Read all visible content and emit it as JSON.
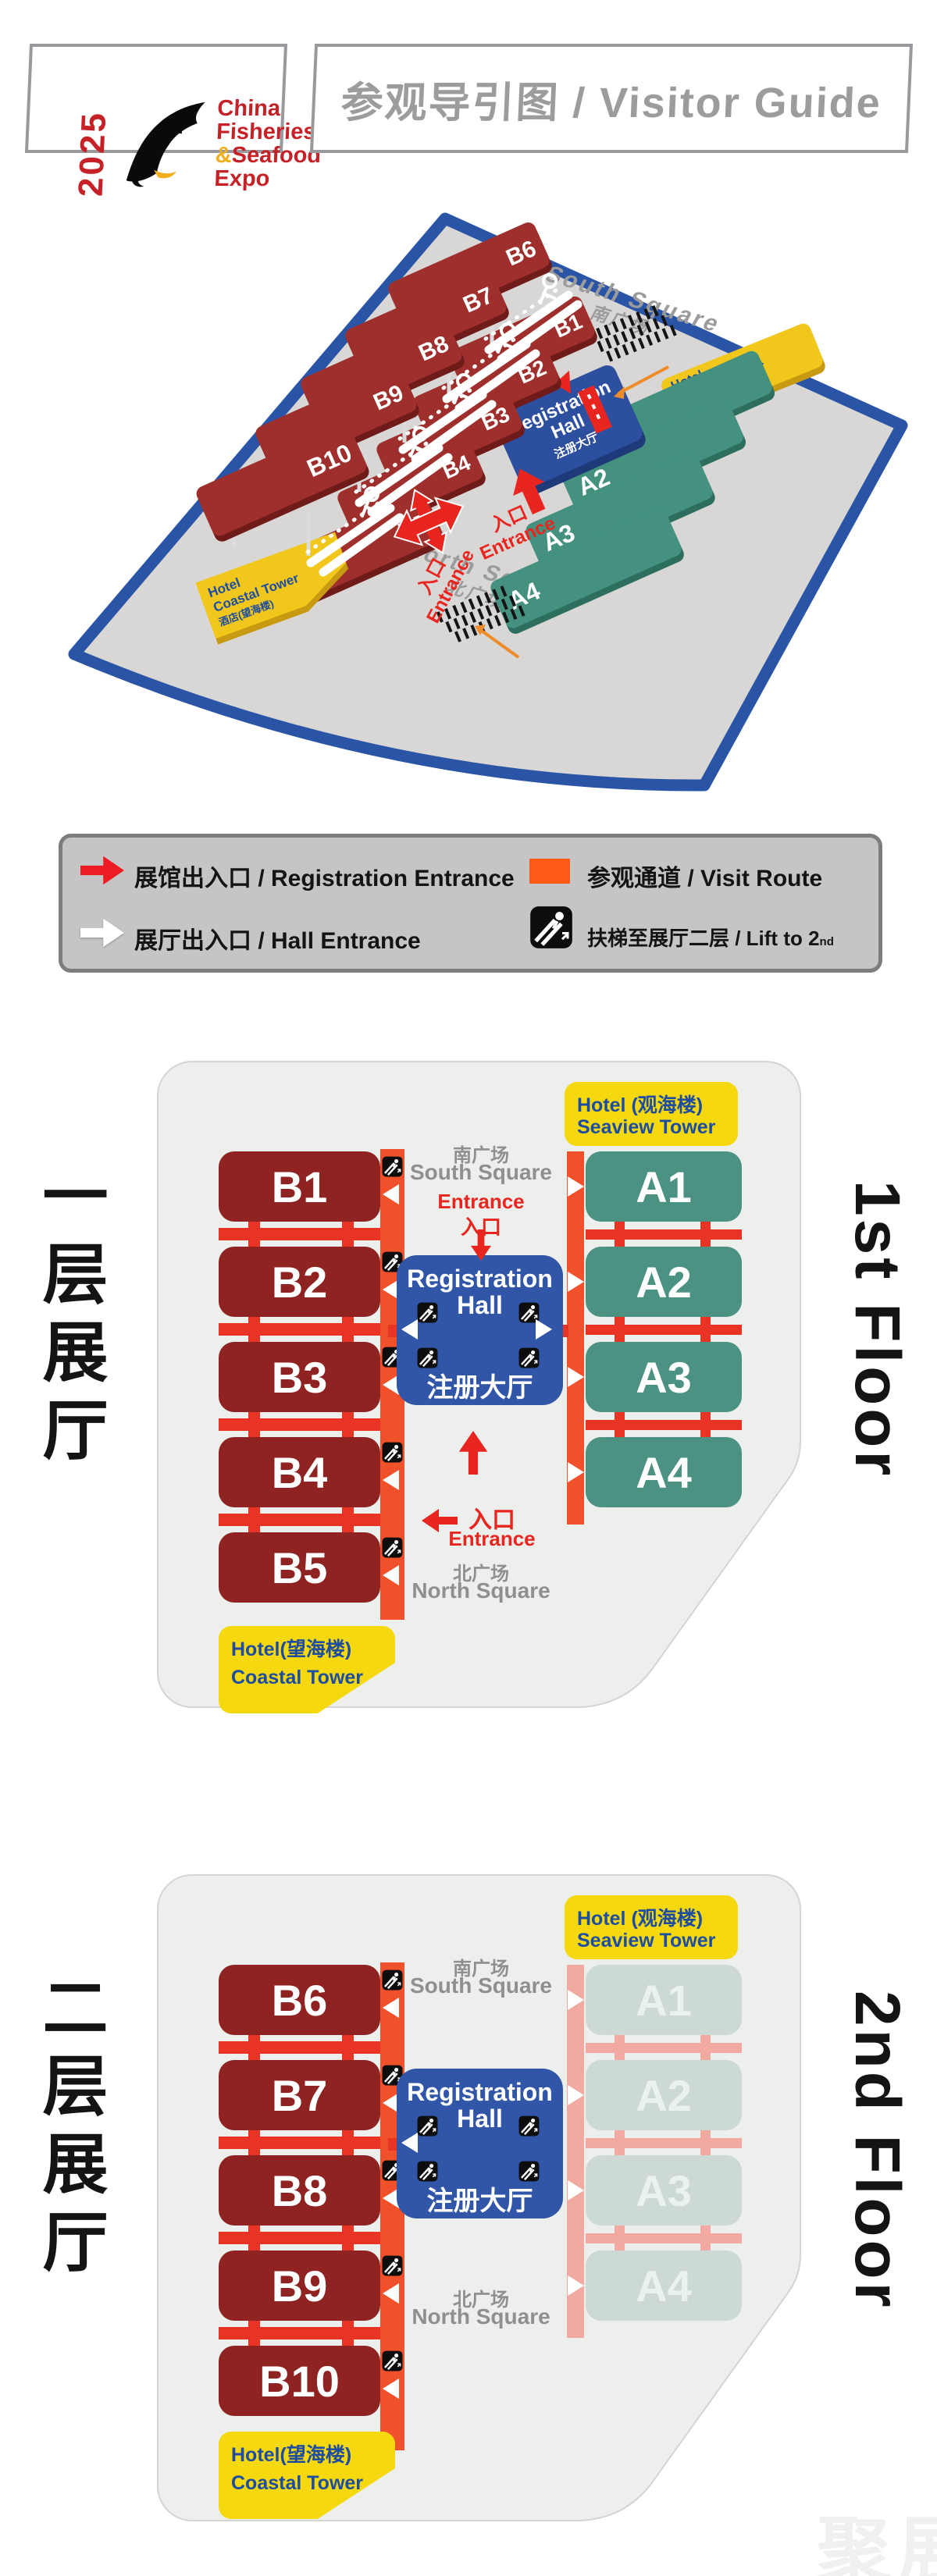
{
  "header": {
    "year": "2025",
    "logo": {
      "l1": "China",
      "l2": "Fisheries",
      "amp": "&",
      "l3": "Seafood",
      "l4": "Expo"
    },
    "title": "参观导引图 / Visitor Guide"
  },
  "legend": {
    "registration_entrance": "展馆出入口 / Registration Entrance",
    "visit_route": "参观通道 / Visit Route",
    "hall_entrance": "展厅出入口 / Hall Entrance",
    "lift_prefix": "扶梯至展厅二层 / Lift to 2",
    "lift_sup": "nd",
    "lift_suffix": " Floor"
  },
  "overview": {
    "south_square_en": "South Square",
    "south_square_zh": "南广场",
    "north_square_en": "North Square",
    "north_square_zh": "北广场",
    "entrance_zh": "入口",
    "entrance_en": "Entrance",
    "hotel_seaview": [
      "Hotel",
      "Seaview Tower",
      "酒店(观海楼)"
    ],
    "hotel_coastal": [
      "Hotel",
      "Coastal Tower",
      "酒店(望海楼)"
    ],
    "registration": [
      "Registration",
      "Hall",
      "注册大厅"
    ],
    "b_upper": [
      "B6",
      "B7",
      "B8",
      "B9",
      "B10"
    ],
    "b_lower": [
      "B1",
      "B2",
      "B3",
      "B4",
      "B5"
    ],
    "a_halls": [
      "A1",
      "A2",
      "A3",
      "A4"
    ]
  },
  "floor1": {
    "side_label": "一层展厅",
    "floor_label": "1st Floor",
    "b_halls": [
      "B1",
      "B2",
      "B3",
      "B4",
      "B5"
    ],
    "a_halls": [
      "A1",
      "A2",
      "A3",
      "A4"
    ],
    "registration_l1": "Registration",
    "registration_l2": "Hall",
    "registration_zh": "注册大厅",
    "south_zh": "南广场",
    "south_en": "South Square",
    "entrance_en": "Entrance",
    "entrance_zh": "入口",
    "north_zh": "北广场",
    "north_en": "North Square",
    "hotel_seaview_l1": "Hotel (观海楼)",
    "hotel_seaview_l2": "Seaview Tower",
    "hotel_coastal_l1": "Hotel(望海楼)",
    "hotel_coastal_l2": "Coastal Tower"
  },
  "floor2": {
    "side_label": "二层展厅",
    "floor_label": "2nd Floor",
    "b_halls": [
      "B6",
      "B7",
      "B8",
      "B9",
      "B10"
    ],
    "a_halls": [
      "A1",
      "A2",
      "A3",
      "A4"
    ],
    "registration_l1": "Registration",
    "registration_l2": "Hall",
    "registration_zh": "注册大厅",
    "south_zh": "南广场",
    "south_en": "South Square",
    "north_zh": "北广场",
    "north_en": "North Square",
    "hotel_seaview_l1": "Hotel (观海楼)",
    "hotel_seaview_l2": "Seaview Tower",
    "hotel_coastal_l1": "Hotel(望海楼)",
    "hotel_coastal_l2": "Coastal Tower"
  },
  "watermark": "聚展",
  "colors": {
    "maroon": "#8e2322",
    "teal": "#4b9282",
    "teal_faded": "#cdd9d5",
    "route_orange": "#f0512b",
    "route_pink": "#f2a9a1",
    "connector_red": "#e93425",
    "reg_blue": "#3156a8",
    "hotel_yellow": "#f5d80e",
    "accent_red": "#e8251e",
    "platform_border_blue": "#2a55a7"
  }
}
